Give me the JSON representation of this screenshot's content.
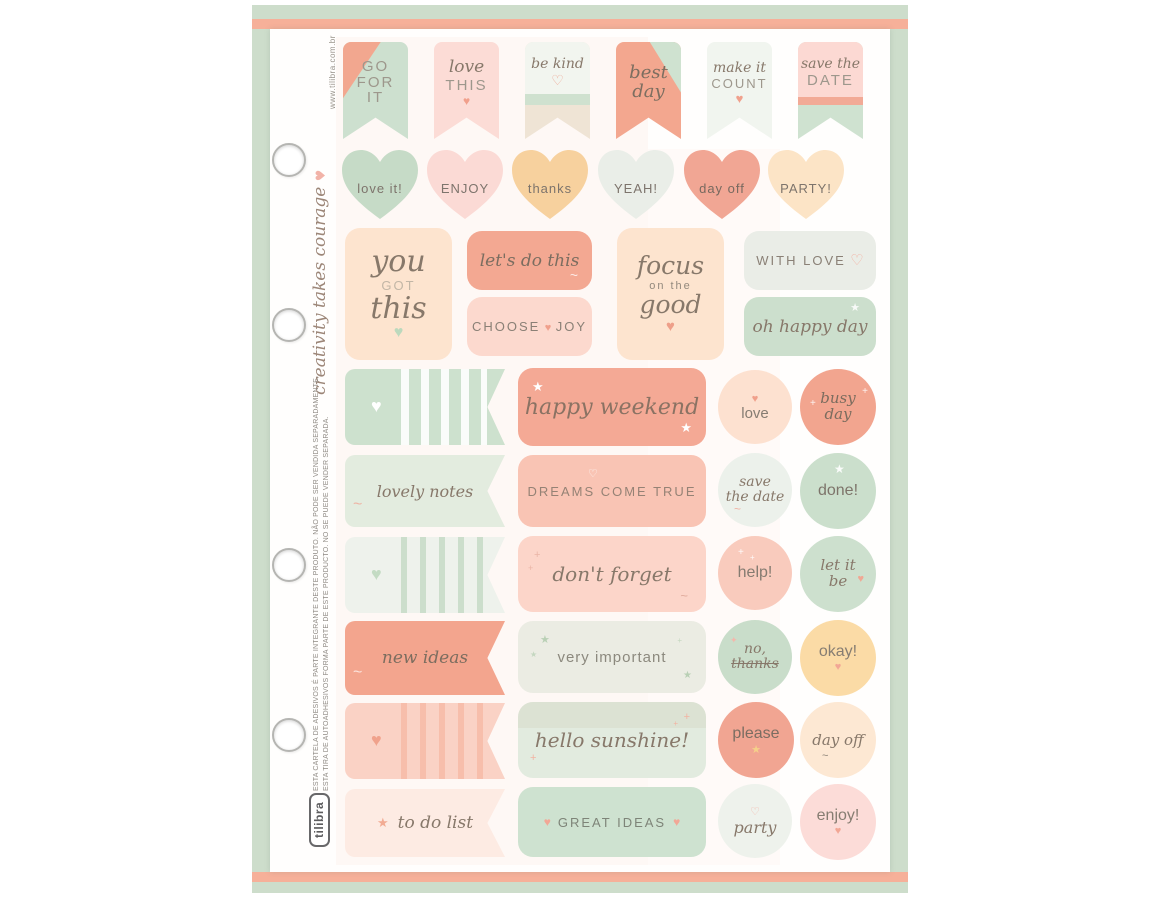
{
  "palette": {
    "backdrop_mint": "#cdddcb",
    "stripe_coral": "#f6b099",
    "sheet_white": "#fffefd",
    "mint": "#cde1ce",
    "mint_light": "#e3ecdf",
    "mint_pale": "#eef2ec",
    "coral": "#f2a58f",
    "salmon_light": "#f9c4b4",
    "pink_light": "#fbd7cc",
    "pink_pale": "#fdebe3",
    "peach": "#fde3cc",
    "orange_light": "#fbdba6",
    "text_gray": "#8a8076"
  },
  "icons": {
    "heart": "♥",
    "heart_outline": "♡",
    "star": "★",
    "sparkle": "✦",
    "plus": "+",
    "swash": "~"
  },
  "side": {
    "website": "www.tilibra.com.br",
    "quote": "creativity takes courage",
    "legal_pt": "ESTA CARTELA DE ADESIVOS É PARTE INTEGRANTE DESTE PRODUTO. NÃO PODE SER VENDIDA SEPARADAMENTE.",
    "legal_es": "ESTA TIRA DE AUTOADHESIVOS FORMA PARTE DE ESTE PRODUCTO. NO SE PUEDE VENDER SEPARADA.",
    "brand": "tilibra"
  },
  "flags": [
    {
      "l1": "GO",
      "l2": "FOR",
      "l3": "IT"
    },
    {
      "script": "love",
      "caps": "THIS"
    },
    {
      "script": "be kind"
    },
    {
      "s1": "best",
      "s2": "day"
    },
    {
      "script": "make it",
      "caps": "COUNT"
    },
    {
      "script": "save the",
      "caps": "DATE"
    }
  ],
  "hearts": [
    {
      "label": "love it!"
    },
    {
      "label": "ENJOY"
    },
    {
      "label": "thanks"
    },
    {
      "label": "YEAH!"
    },
    {
      "label": "day off"
    },
    {
      "label": "PARTY!"
    }
  ],
  "quotes": {
    "you_got_this": {
      "l1": "you",
      "l2": "GOT",
      "l3": "this"
    },
    "lets_do_this": "let's do this",
    "choose_joy_1": "CHOOSE",
    "choose_joy_2": "JOY",
    "focus": {
      "l1": "focus",
      "l2": "on the",
      "l3": "good"
    },
    "with_love": "WITH LOVE",
    "oh_happy_day": "oh happy day"
  },
  "labels": {
    "happy_weekend": "happy weekend",
    "lovely_notes": "lovely notes",
    "dreams_come_true": "DREAMS COME TRUE",
    "dont_forget": "don't forget",
    "new_ideas": "new ideas",
    "very_important": "very important",
    "hello_sunshine": "hello sunshine!",
    "to_do_list": "to do list",
    "great_ideas": "GREAT IDEAS"
  },
  "circles": {
    "love": "love",
    "busy_1": "busy",
    "busy_2": "day",
    "save_1": "save",
    "save_2": "the date",
    "done": "done!",
    "help": "help!",
    "letitbe_1": "let it",
    "letitbe_2": "be",
    "nothanks_1": "no,",
    "nothanks_2": "thanks",
    "okay": "okay!",
    "please": "please",
    "day_off": "day off",
    "party": "party",
    "enjoy": "enjoy!"
  }
}
